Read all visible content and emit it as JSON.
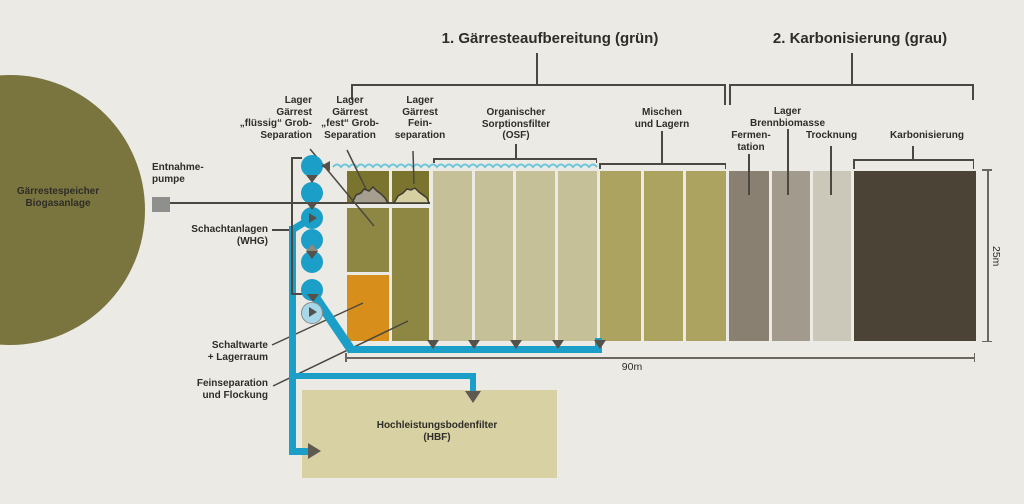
{
  "palette": {
    "background": "#ECEAE4",
    "storage_olive": "#7A743F",
    "cell_dark_olive": "#7B742F",
    "cell_olive": "#8E8744",
    "cell_light": "#C6C099",
    "cell_medium_olive": "#ABA35F",
    "cell_grey_dark": "#8A8072",
    "cell_grey": "#A29A8D",
    "cell_grey_light": "#CBC7B9",
    "cell_brown": "#4A4336",
    "cell_orange": "#D88E1B",
    "hbf_fill": "#D7D1A3",
    "pipe_blue": "#1B9EC7",
    "pump_light_blue": "#A6D8E9",
    "wave_blue": "#6FC6DB",
    "line_dark": "#4A4840",
    "dim_grey": "#6B675F",
    "arrow_grey": "#5E5A50",
    "tri_grey": "#54504A",
    "tri_light": "#8D897E",
    "text": "#2E2D27",
    "pump_square_grey": "#8F8F8D",
    "pile_grey": "#A69F90",
    "pile_beige": "#D6CFA2"
  },
  "sections": {
    "s1": "1. Gärresteaufbereitung (grün)",
    "s2": "2. Karbonisierung (grau)"
  },
  "storage": {
    "line1": "Gärrestespeicher",
    "line2": "Biogasanlage"
  },
  "labels": {
    "lager_fluessig": [
      "Lager",
      "Gärrest",
      "„flüssig“ Grob-",
      "Separation"
    ],
    "lager_fest": [
      "Lager",
      "Gärrest",
      "„fest“ Grob-",
      "Separation"
    ],
    "lager_fein": [
      "Lager",
      "Gärrest",
      "Fein-",
      "separation"
    ],
    "osf": [
      "Organischer",
      "Sorptionsfilter",
      "(OSF)"
    ],
    "mischen": [
      "Mischen",
      "und Lagern"
    ],
    "fermentation": [
      "Fermen-",
      "tation"
    ],
    "brennbiomasse": [
      "Lager",
      "Brennbiomasse"
    ],
    "trocknung": "Trocknung",
    "karbonisierung": "Karbonisierung",
    "entnahmepumpe": [
      "Entnahme-",
      "pumpe"
    ],
    "schachtanlagen": [
      "Schachtanlagen",
      "(WHG)"
    ],
    "schaltwarte": [
      "Schaltwarte",
      "+ Lagerraum"
    ],
    "feinseparation": [
      "Feinseparation",
      "und Flockung"
    ],
    "hbf": [
      "Hochleistungsbodenfilter",
      "(HBF)"
    ]
  },
  "dimensions": {
    "width": "90m",
    "height": "25m"
  }
}
